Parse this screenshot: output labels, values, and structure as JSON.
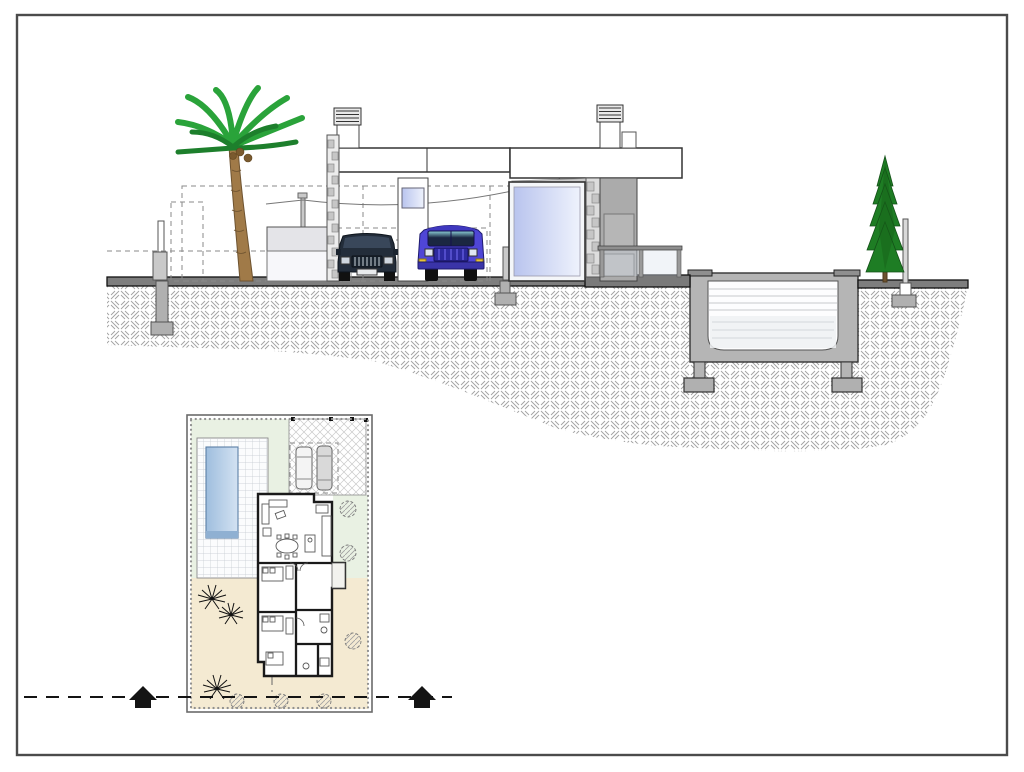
{
  "meta": {
    "drawing_type": "architectural-drawing",
    "views": [
      "street-side-section-elevation",
      "ground-floor-site-plan"
    ],
    "visible_text": "none"
  },
  "palette": {
    "page": "#ffffff",
    "frame": "#4b4b4b",
    "ground_band": "#7e7e7e",
    "pool_structure": "#b5b5b5",
    "pool_cap": "#8f8f8f",
    "footing_gray": "#b0b0b0",
    "stone_fill": "#ececec",
    "stone_block": "#c6c6c6",
    "wall_gray": "#ababab",
    "wall_gray_panel": "#b6b6b6",
    "soffit_gray": "#c9c9c9",
    "deck_dark": "#7a7a7a",
    "glass_dark": "#b9c4ee",
    "glass_light": "#eef2fc",
    "water_lower": "#eef1f3",
    "palm_green": "#2aa33a",
    "palm_green_dark": "#1d7f2c",
    "palm_trunk": "#a07a48",
    "palm_trunk_dark": "#6e5330",
    "coconut_brown": "#7a5a2e",
    "cypress_green": "#1e7d24",
    "cypress_dark": "#145018",
    "sedan_body": "#232d3a",
    "sedan_roof": "#39475a",
    "sedan_grille": "#c9d2da",
    "suv_body": "#4f46d6",
    "suv_roof": "#3f38bf",
    "suv_grille": "#2d2a9e",
    "suv_window": "#1b2742",
    "signal_yellow": "#e8c436",
    "headlight_white": "#dfe6f2",
    "post_gray": "#c9c9c9",
    "plan_green": "#e9f1e3",
    "plan_beige": "#f4ead2",
    "plan_pool_dark": "#9fbede",
    "plan_pool_light": "#d3e2f2",
    "plan_pool_step": "#8fb0d2",
    "plan_tile_base": "#fbfcfd",
    "plan_car_light": "#f4f4f4",
    "plan_car_gray": "#d9d9d9",
    "section_black": "#141414"
  },
  "elevation": {
    "elements": [
      "palm-tree",
      "boundary-fence-posts",
      "low-garden-wall",
      "carport",
      "sedan-car",
      "suv-car",
      "entry-pillar",
      "large-glass-window",
      "stone-clad-pier",
      "gray-feature-wall",
      "flat-roof-band",
      "two-chimneys",
      "terrace-railing",
      "swimming-pool-cross-section",
      "cypress-tree",
      "ground-hatch",
      "hidden-line-dashes",
      "overhead-cable"
    ]
  },
  "site_plan": {
    "elements": [
      "plot-boundary-stone-border",
      "swimming-pool",
      "tiled-pool-deck",
      "lawn-area",
      "driveway-paving",
      "two-parked-cars-plan",
      "carport-dashed-outline",
      "house-floor-plan",
      "living-dining-kitchen-furniture",
      "three-bedrooms",
      "bathrooms",
      "garden-shrub-circles",
      "palm-symbols",
      "sand-colored-terrain",
      "boundary-posts"
    ]
  },
  "section_markers": {
    "style": "dashed-cut-line-with-solid-arrows",
    "arrow_count": 2,
    "arrow_direction": "up"
  }
}
